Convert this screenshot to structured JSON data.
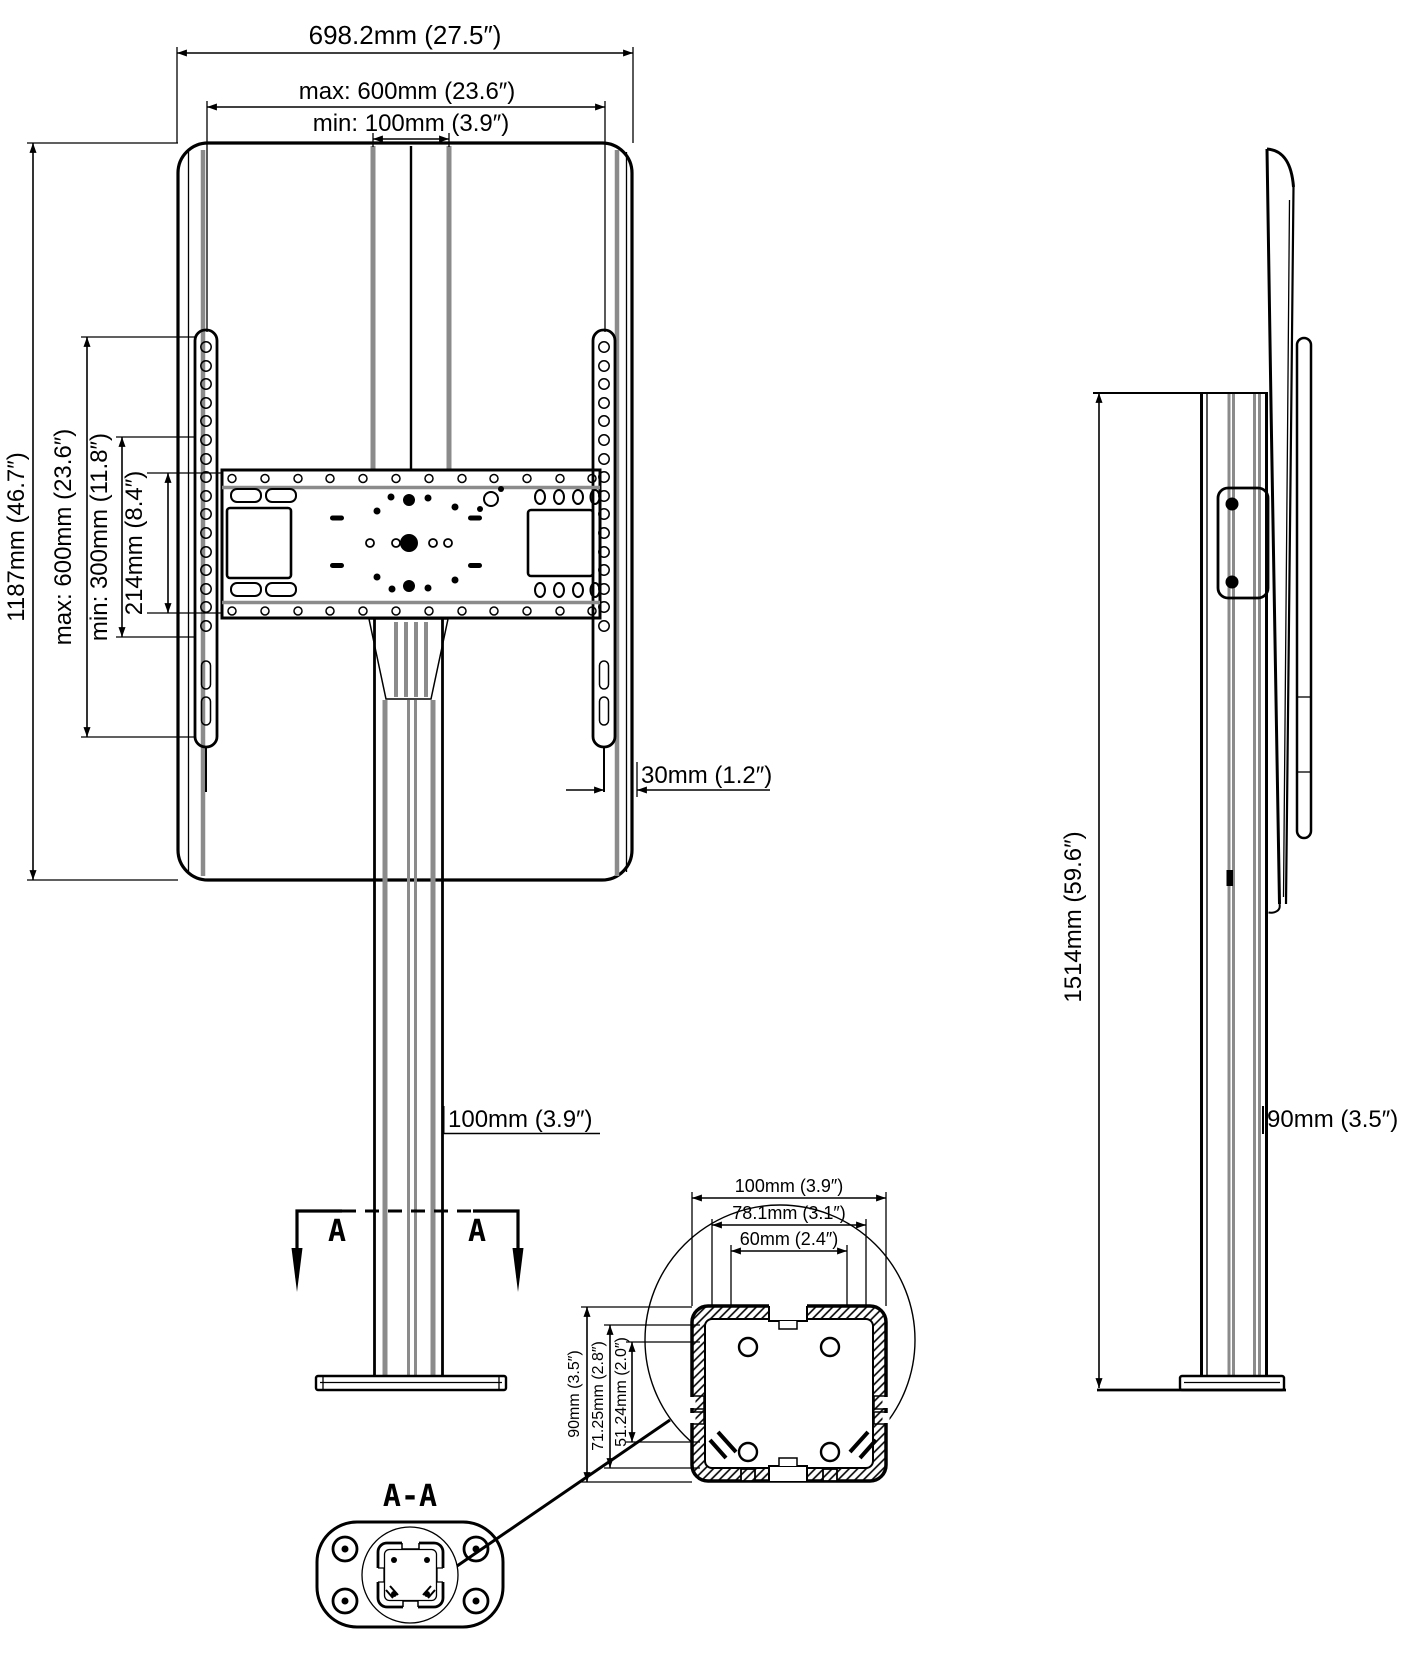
{
  "front_view": {
    "width_overall": "698.2mm (27.5″)",
    "width_max": "max: 600mm (23.6″)",
    "width_min": "min: 100mm (3.9″)",
    "height_overall": "1187mm (46.7″)",
    "height_max": "max: 600mm (23.6″)",
    "height_min": "min: 300mm (11.8″)",
    "plate_height": "214mm (8.4″)",
    "bracket_offset": "30mm (1.2″)",
    "column_width": "100mm (3.9″)",
    "section_label_left": "A",
    "section_label_right": "A"
  },
  "side_view": {
    "total_height": "1514mm (59.6″)",
    "column_depth": "90mm (3.5″)"
  },
  "section_view": {
    "title": "A-A"
  },
  "detail_view": {
    "outer_width": "100mm (3.9″)",
    "groove_width": "78.1mm (3.1″)",
    "inner_width": "60mm (2.4″)",
    "outer_depth": "90mm (3.5″)",
    "groove_depth": "71.25mm (2.8″)",
    "inner_depth": "51.24mm (2.0″)"
  },
  "colors": {
    "line": "#000000",
    "strap_gray": "#8b8b8b",
    "background": "#ffffff"
  }
}
